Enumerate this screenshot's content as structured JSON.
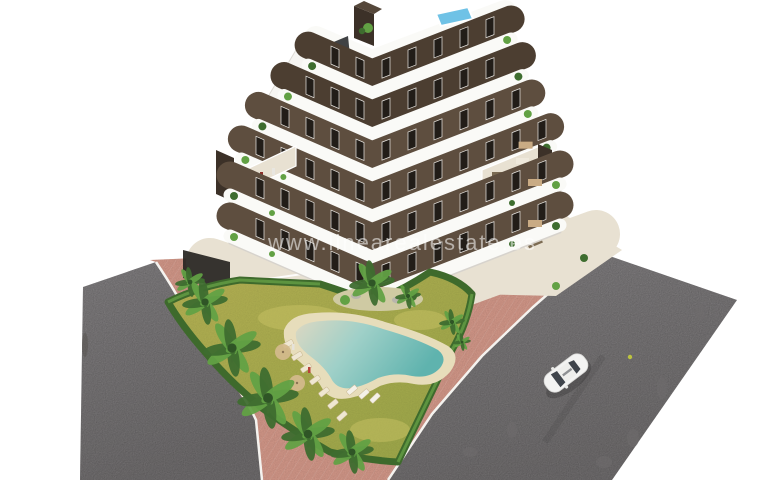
{
  "watermark": {
    "text": "www.linearealestate.es"
  },
  "palette": {
    "background": "#ffffff",
    "road": "#8b8889",
    "road_light": "#949192",
    "road_dark": "#6f6c6d",
    "sidewalk_pink": "#e0a191",
    "sidewalk_pink_light": "#eab4a5",
    "curb_white": "#f5f3ef",
    "lawn": "#b5b452",
    "lawn_dark": "#a2ae4c",
    "lawn_light": "#c8c263",
    "hedge": "#3e6a2c",
    "hedge_light": "#5d9440",
    "palm_dark": "#3e6d2f",
    "palm_light": "#62a144",
    "palm_trunk": "#8a7354",
    "pool_sand": "#e7ddbb",
    "pool_water_deep": "#5fb3ae",
    "pool_water_shallow": "#d9d6c0",
    "deck_beige": "#e8e1d2",
    "building_white": "#fafaf7",
    "band_shadow": "#d7d3cd",
    "wall_brown": "#5e4e3f",
    "wall_brown_dark": "#4c3e31",
    "window_dark": "#221d18",
    "window_frame": "#eceae6",
    "chimney": "#3c3128",
    "rooftop_pool": "#6fc2e6",
    "car_body": "#f3f3f2",
    "car_glass": "#3f444b",
    "watermark_white": "#ffffff"
  }
}
